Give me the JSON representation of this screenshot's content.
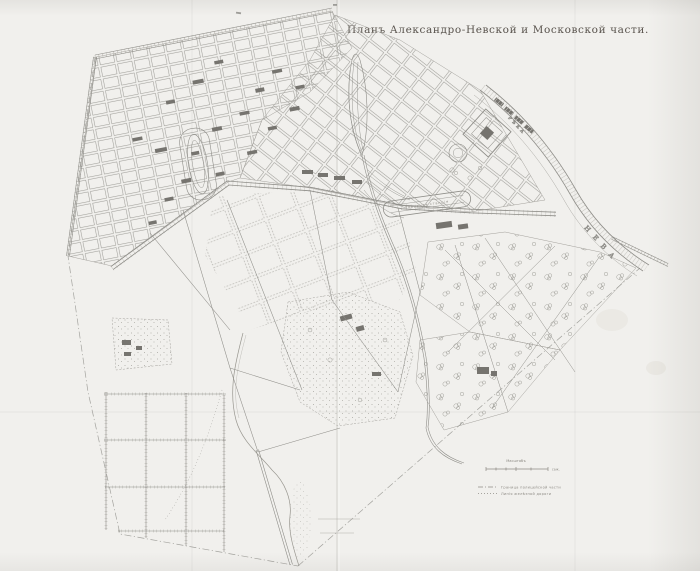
{
  "meta": {
    "kind": "scanned-historical-city-plan",
    "language": "russian-pre-1918"
  },
  "title": {
    "text": "Планъ Александро-Невской и Московской части."
  },
  "colors": {
    "paper": "#f1f0ed",
    "map_ink": "#8f8e89",
    "building_ink": "#76746f",
    "title_ink": "#59534d"
  },
  "labels": {
    "river_upper": "РѢКА",
    "river_main": "НЕВА",
    "freight_station": "Товарная станція"
  },
  "legend": {
    "scale_label": "Масштабъ",
    "scale_unit": "саж.",
    "items": [
      {
        "id": "district-boundary",
        "label": "Граница полицейской части"
      },
      {
        "id": "railway-line",
        "label": "Линія желѣзной дороги"
      }
    ]
  }
}
